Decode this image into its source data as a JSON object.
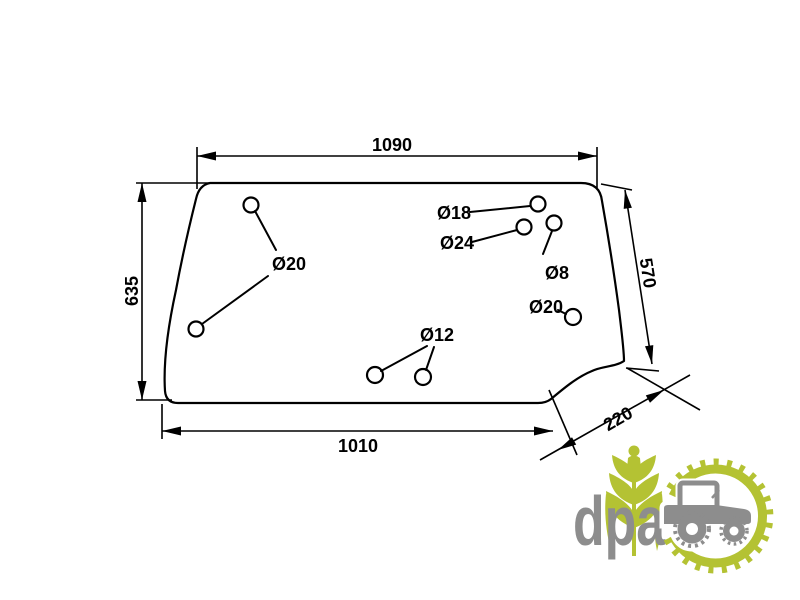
{
  "drawing": {
    "line_color": "#000000",
    "dimensions": {
      "top_width": "1090",
      "left_height": "635",
      "right_height": "570",
      "bottom_width": "1010",
      "notch_width": "220"
    },
    "holes": {
      "left_pair": "Ø20",
      "d18": "Ø18",
      "d24": "Ø24",
      "d8": "Ø8",
      "d20_right": "Ø20",
      "d12_pair": "Ø12"
    }
  },
  "logo": {
    "text": "dpa",
    "green": "#b4c233",
    "gray": "#8d8d8d",
    "icons": [
      "wheat-icon",
      "gear-ring-icon",
      "tractor-icon"
    ]
  }
}
